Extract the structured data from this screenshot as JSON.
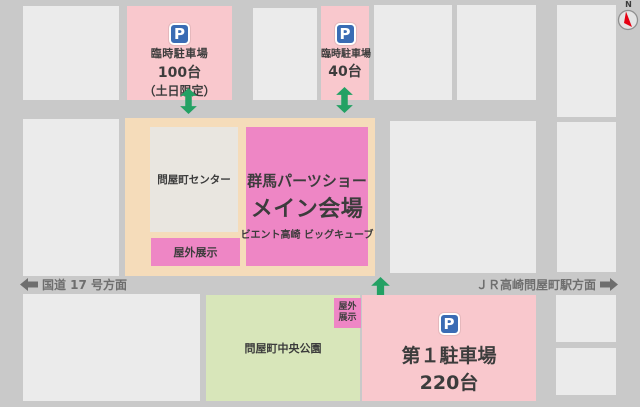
{
  "map": {
    "compass": {
      "north_label": "N"
    },
    "roads": {
      "left_direction": "国道 17 号方面",
      "right_direction": "ＪＲ高崎問屋町駅方面"
    },
    "temporary_parking_1": {
      "name": "臨時駐車場",
      "capacity": "100台",
      "note": "（土日限定）",
      "sign": "P"
    },
    "temporary_parking_2": {
      "name": "臨時駐車場",
      "capacity": "40台",
      "sign": "P"
    },
    "main_parking": {
      "name": "第１駐車場",
      "capacity": "220台",
      "sign": "P"
    },
    "center_building": {
      "label": "問屋町センター"
    },
    "venue": {
      "title": "群馬パーツショー",
      "subtitle": "メイン会場",
      "location": "ビエント高崎 ビッグキューブ"
    },
    "outdoor_exhibit_main": {
      "label": "屋外展示"
    },
    "outdoor_exhibit_side": {
      "line1": "屋外",
      "line2": "展示"
    },
    "park": {
      "label": "問屋町中央公園"
    }
  },
  "colors": {
    "road": "#c9c9c9",
    "city_block": "#ebebeb",
    "parking_pink": "#f9c8cd",
    "venue_magenta": "#ee86c5",
    "venue_ground_peach": "#f5dcba",
    "center_building_gray": "#e9e6e0",
    "park_green": "#d8e6ba",
    "entrance_arrow_green": "#23a164",
    "parking_sign_blue": "#3a6cb4",
    "compass_red": "#e60012",
    "road_label_gray": "#6e6e6e",
    "text_dark": "#3c3c3c"
  }
}
